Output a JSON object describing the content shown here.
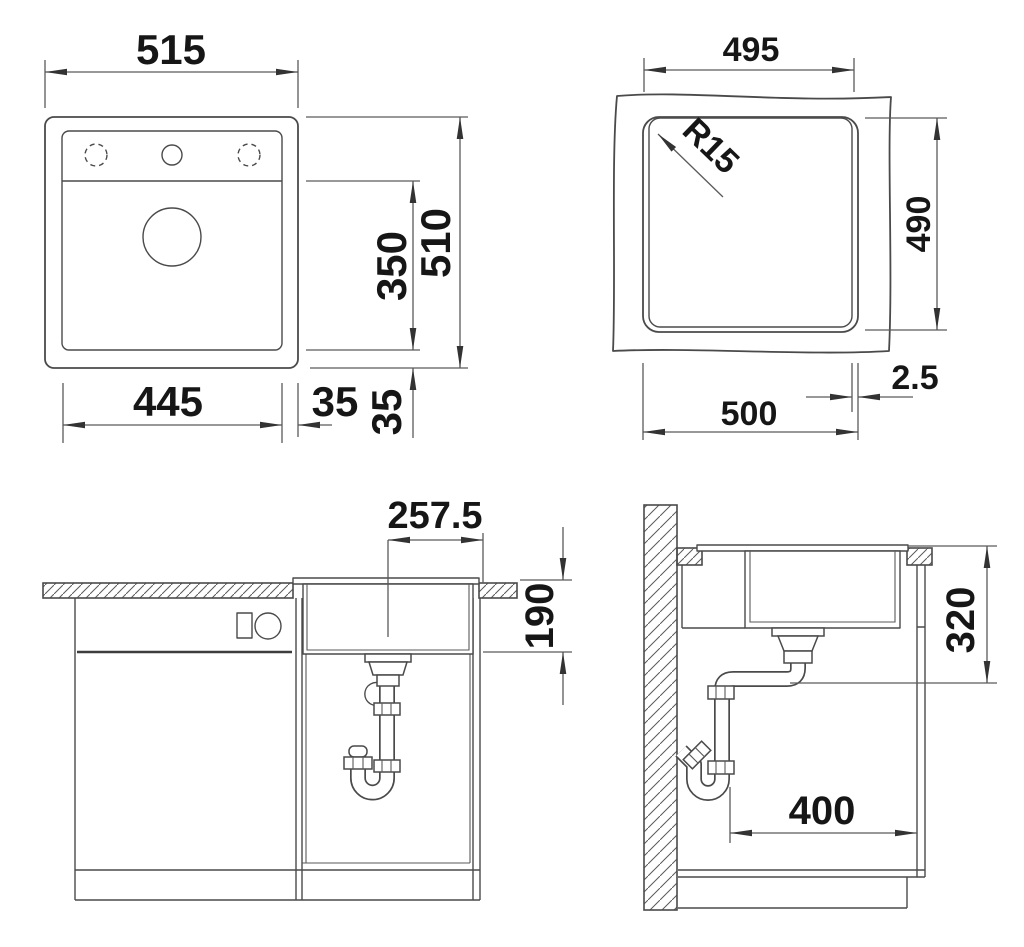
{
  "drawing_title": "Sink installation dimension drawing",
  "views": {
    "plan": {
      "overall_width": "515",
      "overall_height": "510",
      "bowl_width": "445",
      "bowl_height": "350",
      "margin_right": "35",
      "margin_bottom": "35"
    },
    "cutout": {
      "inner_width": "495",
      "cutout_height": "490",
      "cutout_width": "500",
      "corner_radius": "R15",
      "edge_gap": "2.5"
    },
    "front": {
      "drain_center_offset": "257.5",
      "bowl_depth": "190"
    },
    "side": {
      "install_depth": "320",
      "drain_wall_distance": "400"
    }
  },
  "colors": {
    "line": "#4a4a4a",
    "dimension_line": "#5a5a5a",
    "text": "#161616",
    "background": "#ffffff"
  }
}
